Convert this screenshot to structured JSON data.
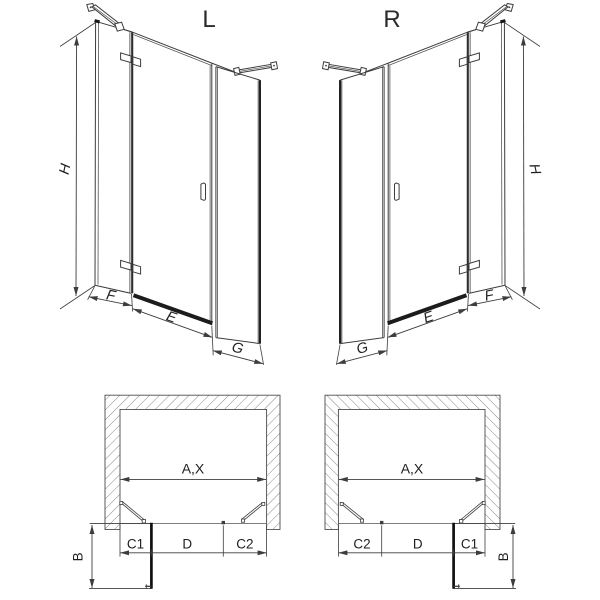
{
  "colors": {
    "line": "#3d3d3d",
    "dark": "#161616",
    "hatch": "#6b6b6b",
    "text": "#1f1f1f",
    "background": "#ffffff"
  },
  "variants": {
    "left": {
      "title": "L",
      "front": {
        "height": "H",
        "fixed": "F",
        "door": "E",
        "side": "G"
      },
      "plan": {
        "opening": "A,X",
        "segments": [
          "C1",
          "D",
          "C2"
        ],
        "depth": "B"
      }
    },
    "right": {
      "title": "R",
      "front": {
        "height": "H",
        "fixed": "F",
        "door": "E",
        "side": "G"
      },
      "plan": {
        "opening": "A,X",
        "segments": [
          "C2",
          "D",
          "C1"
        ],
        "depth": "B"
      }
    }
  }
}
